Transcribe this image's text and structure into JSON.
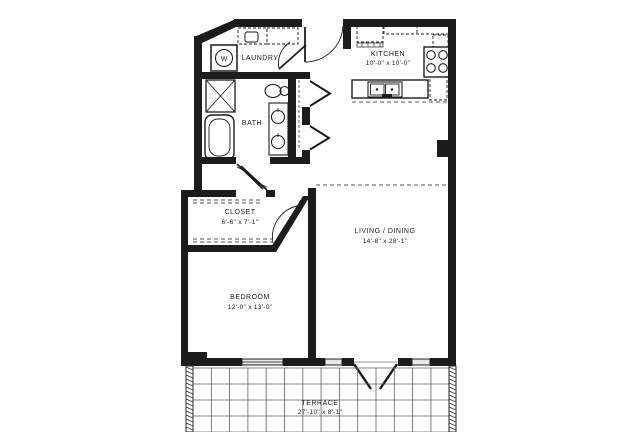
{
  "meta": {
    "type": "apartment-floor-plan",
    "background_color": "#ffffff",
    "wall_color": "#1c1c1c",
    "grid_color": "#5f5f5f"
  },
  "rooms": {
    "laundry": {
      "label": "LAUNDRY"
    },
    "kitchen": {
      "label": "KITCHEN",
      "dims": "10'-0\" x 10'-0\""
    },
    "bath": {
      "label": "BATH"
    },
    "closet": {
      "label": "CLOSET",
      "dims": "6'-6\" x 7'-1\""
    },
    "living_dining": {
      "label": "LIVING / DINING",
      "dims": "14'-8\" x 28'-1\""
    },
    "bedroom": {
      "label": "BEDROOM",
      "dims": "12'-0\" x 13'-0\""
    },
    "terrace": {
      "label": "TERRACE",
      "dims": "27'-10\" x 8'-1\""
    }
  },
  "symbols": {
    "washer_glyph": "W",
    "fixture_icons": [
      "washer-icon",
      "laundry-counter-icon",
      "shower-icon",
      "bathtub-icon",
      "toilet-icon",
      "vanity-sinks-icon",
      "refrigerator-icon",
      "range-icon",
      "island-sink-icon",
      "entry-door",
      "laundry-door",
      "bath-door",
      "closet-door",
      "bedroom-door",
      "linen-closet-doors",
      "french-doors",
      "window",
      "terrace-grid"
    ]
  }
}
